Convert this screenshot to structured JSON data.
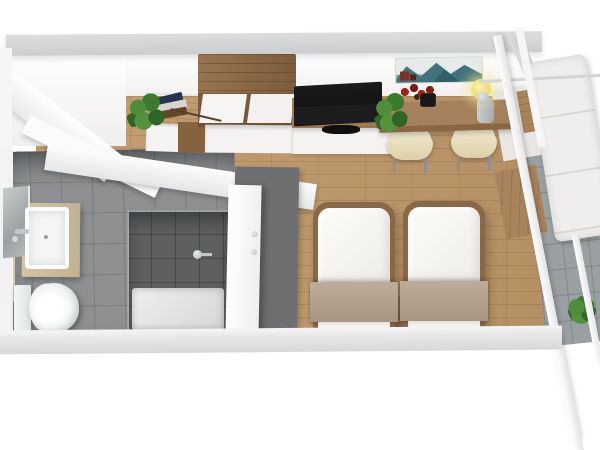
{
  "scene": {
    "kind": "3d-floorplan-render",
    "background": "#ffffff"
  },
  "palette": {
    "wall_top": "#cccdce",
    "wall_face": "#f1f0ef",
    "wood_floor": "#c0996a",
    "tile": "#8d8f91",
    "tile_dark": "#5d5f61",
    "rug": "#6e6f71",
    "wood": "#9c7851",
    "unit_white": "#f4f3f1",
    "tv": "#0f0f0f",
    "duvet": "#efede9",
    "runner": "#a69681",
    "bed_frame": "#8a6747",
    "chair": "#ddd0a9",
    "plant": "#3c7a31",
    "plant_dark": "#2f6628",
    "flower": "#a91f16",
    "lamp": "#e6cf5f",
    "metal": "#c3c6c8",
    "mirror_a": "#c9cccd",
    "mirror_b": "#9da1a3",
    "balcony_tile": "#9aa0a1",
    "deck": "#97744f",
    "lounge": "#efeeec",
    "band": "#d8d8d8",
    "pic_sky": "#e7ebe8",
    "pic_mtn": "#40727c",
    "pic_mtn2": "#2e5f6a",
    "pic_water": "#8fae9d",
    "pic_bldg": "#7c3126"
  },
  "rooms": {
    "bathroom": "Bathroom",
    "bedroom": "Bedroom / living area",
    "hallway": "Entry hallway",
    "balcony": "Balcony"
  },
  "objects": {
    "mirror": "Wall mirror",
    "washbasin": "Washbasin",
    "vanity": "Vanity cabinet",
    "toilet": "Toilet",
    "shower": "Walk-in shower",
    "shower_head": "Shower head",
    "bathroom_door": "Bathroom door (open)",
    "entry_door": "Entry door",
    "sideboard": "Sideboard",
    "books": "Stack of books",
    "wardrobe": "Wardrobe",
    "media_console": "Media console",
    "tv": "Flat-screen TV",
    "desk": "Desk",
    "chair": "Upholstered chair",
    "plant": "Potted plant",
    "flowers": "Red flowers",
    "phone": "Telephone",
    "lamp": "Table lamp",
    "picture": "Panorama wall picture",
    "rug": "Gray rug",
    "bed1": "Twin bed 1",
    "bed2": "Twin bed 2",
    "runner": "Bed runner",
    "nightstand": "Nightstand",
    "lounge": "Balcony lounge sofa",
    "balcony_plant": "Balcony plant",
    "railing": "Balcony railing",
    "glass_door": "Glass sliding door",
    "wood_floor": "Wood flooring",
    "tile_floor": "Bathroom tile floor"
  }
}
